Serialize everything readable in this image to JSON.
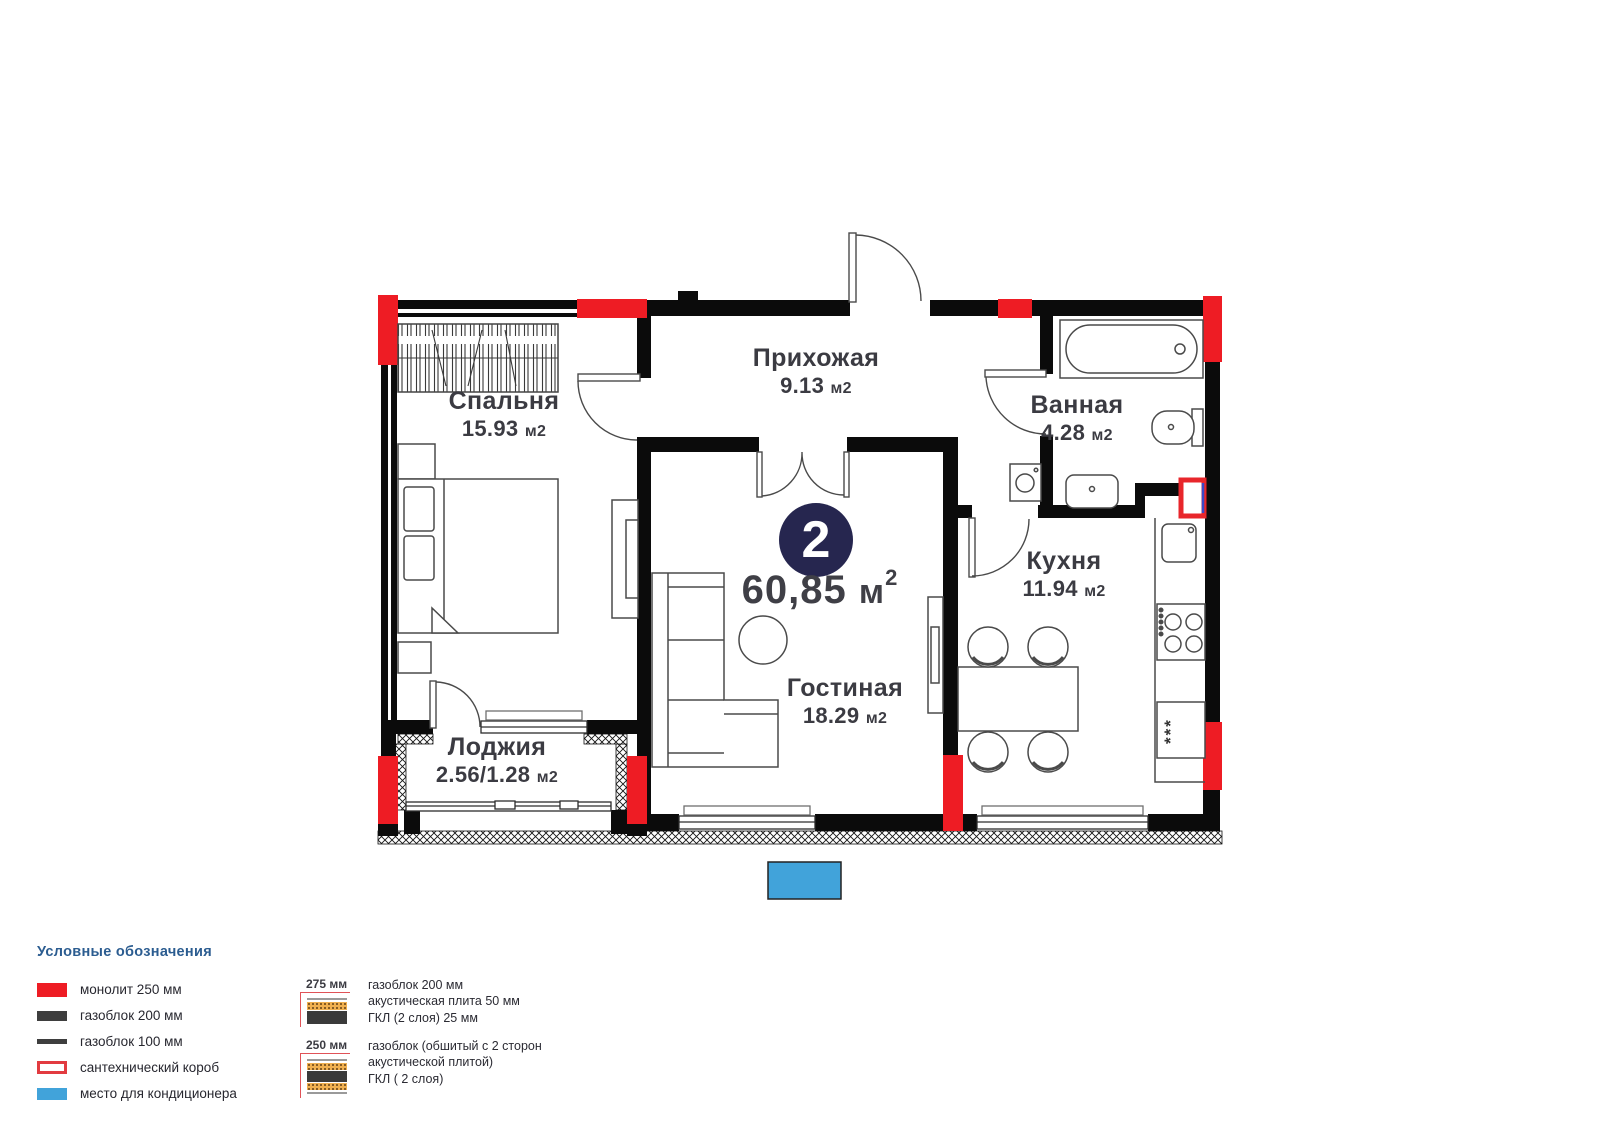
{
  "unit": {
    "number": "2",
    "area_value": "60,85",
    "area_unit": "м",
    "area_sup": "2"
  },
  "rooms": {
    "bedroom": {
      "name": "Спальня",
      "area": "15.93",
      "unit": "м2"
    },
    "hallway": {
      "name": "Прихожая",
      "area": "9.13",
      "unit": "м2"
    },
    "bathroom": {
      "name": "Ванная",
      "area": "4.28",
      "unit": "м2"
    },
    "kitchen": {
      "name": "Кухня",
      "area": "11.94",
      "unit": "м2"
    },
    "living": {
      "name": "Гостиная",
      "area": "18.29",
      "unit": "м2"
    },
    "loggia": {
      "name": "Лоджия",
      "area": "2.56/1.28",
      "unit": "м2"
    }
  },
  "plan": {
    "freezer_marks": "***"
  },
  "legend": {
    "title": "Условные обозначения",
    "items": [
      {
        "label": "монолит 250 мм"
      },
      {
        "label": "газоблок 200 мм"
      },
      {
        "label": "газоблок 100 мм"
      },
      {
        "label": "сантехнический короб"
      },
      {
        "label": "место для кондиционера"
      }
    ]
  },
  "wall_sections": [
    {
      "dimension": "275 мм",
      "line1": "газоблок 200 мм",
      "line2": "акустическая плита 50 мм",
      "line3": "ГКЛ (2 слоя) 25 мм"
    },
    {
      "dimension": "250 мм",
      "line1": "газоблок (обшитый с 2 сторон",
      "line2": "акустической плитой)",
      "line3": "ГКЛ ( 2 слоя)"
    }
  ],
  "colors": {
    "monolith_red": "#ee1c24",
    "wall_black": "#0b0b0b",
    "badge_navy": "#26264f",
    "ac_blue": "#41a3da",
    "acoustic_orange": "#f0b050"
  }
}
